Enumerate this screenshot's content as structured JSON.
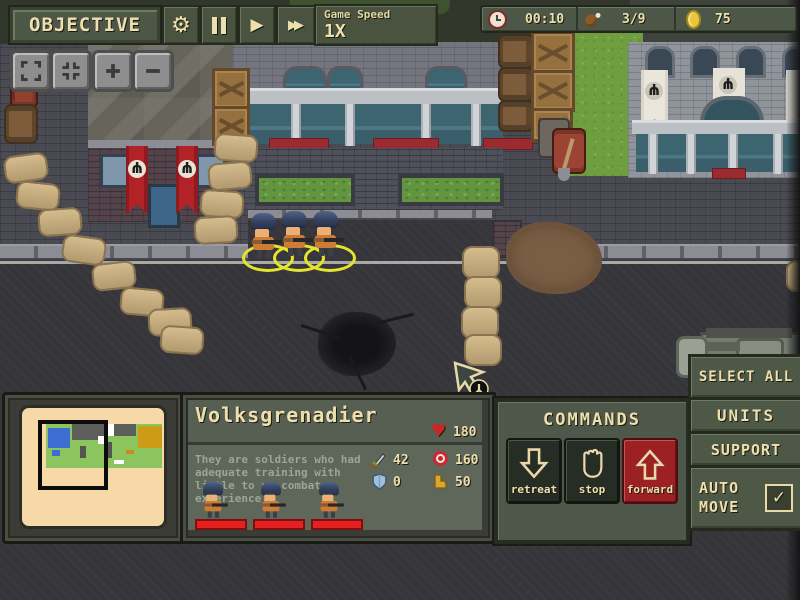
{
  "toolbar": {
    "objective": "OBJECTIVE",
    "speed_label": "Game Speed",
    "speed_value": "1X"
  },
  "hud": {
    "time": "00:10",
    "rations": "3/9",
    "coins": "75"
  },
  "unit_panel": {
    "name": "Volksgrenadier",
    "health": "180",
    "description": "They are soldiers who had adequate training with little to no combat experience",
    "stats": {
      "attack": "42",
      "range": "160",
      "armor": "0",
      "speed": "50"
    }
  },
  "commands": {
    "title": "COMMANDS",
    "retreat": "retreat",
    "stop": "stop",
    "forward": "forward"
  },
  "side_panel": {
    "select_all": "SELECT ALL",
    "units": "UNITS",
    "support": "SUPPORT",
    "auto_move": "AUTO MOVE",
    "auto_move_checked": true
  },
  "icons": {
    "gear": "⚙",
    "play": "▶",
    "fast_forward": "▶▶",
    "heart": "♥",
    "check": "✓",
    "emblem": "ψ"
  },
  "colors": {
    "cream": "#efdfae",
    "panel_olive": "#4d5747",
    "forward_red": "#9b2125",
    "health_red": "#e42020",
    "coin_gold": "#e7c83d",
    "selection_yellow": "#e4e42c",
    "minimap_cream": "#f6d9a6"
  }
}
